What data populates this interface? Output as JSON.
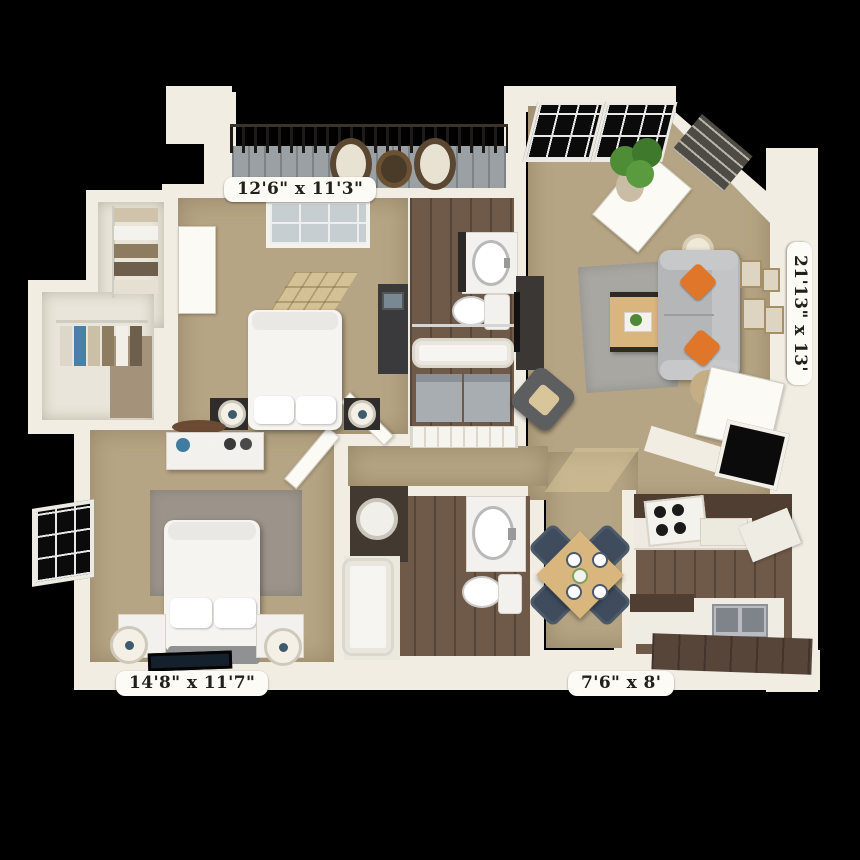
{
  "labels": {
    "bedroom1": "12'6\" x 11'3\"",
    "living_room": "21'13\" x 13'",
    "bedroom2": "14'8\" x 11'7\"",
    "kitchen": "7'6\" x 8'"
  },
  "colors": {
    "background": "#000000",
    "wall": "#f1ede3",
    "carpet": "#b6a584",
    "wood_floor": "#6f5948",
    "closet_floor": "#e9e5da",
    "balcony_deck": "#9aa0a4",
    "countertop": "#4f3e31",
    "sofa": "#b4b6b8",
    "pillow_orange": "#e0762a",
    "dining_chair": "#3e4c5e",
    "table_wood": "#d8b67d",
    "plant": "#4e8c36",
    "rug_living": "#a8a7a2",
    "rug_bedroom": "#9c948a"
  }
}
